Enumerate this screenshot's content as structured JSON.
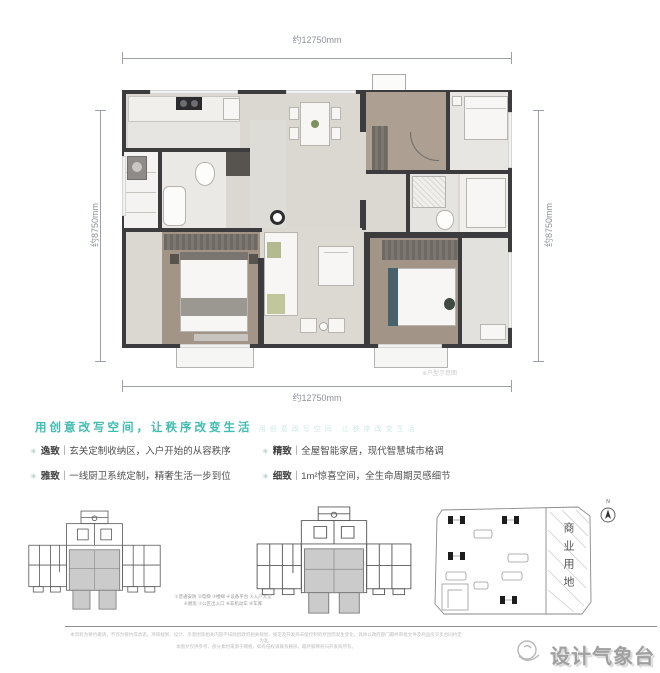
{
  "plan": {
    "dim_top": "约12750mm",
    "dim_bottom": "约12750mm",
    "dim_left": "约8750mm",
    "dim_right": "约8750mm",
    "note": "※户型示意图"
  },
  "headline": {
    "text": "用创意改写空间，让秩序改变生活",
    "echo": "用创意改写空间 让秩序改变生活"
  },
  "features": [
    {
      "tag": "逸致",
      "sep": "｜",
      "desc": "玄关定制收纳区，入户开始的从容秩序"
    },
    {
      "tag": "雅致",
      "sep": "｜",
      "desc": "一线厨卫系统定制，精奢生活一步到位"
    },
    {
      "tag": "精致",
      "sep": "｜",
      "desc": "全屋智能家居，现代智慧城市格调"
    },
    {
      "tag": "细致",
      "sep": "｜",
      "desc": "1m²惊喜空间，全生命周期灵感细节"
    }
  ],
  "keyplan": {
    "legend_line1": "①普通安防 ②电梯 ③楼梯 ④设备平台 ⑤入户大堂",
    "legend_line2": "⑥厨房 ⑦公区出入口 ⑧非机动车 ⑨车库"
  },
  "siteplan": {
    "label": "商业用地",
    "compass": "N"
  },
  "footer": {
    "disclaimer1": "本资料为要约邀请，不作为要约或承诺。项目规划、设计、示意图等相关内容不排除因政府相关规划、规定及开发商未能控制的原因而发生变化，具体以政府部门最终审批文件及商品房买卖合同约定为准。",
    "disclaimer2": "本图文仅供参考，部分素材来源于网络，如有侵权请联系删除，最终解释权归开发商所有。",
    "brand": "设计气象台"
  },
  "colors": {
    "accent": "#3fbdb0",
    "wall": "#3c3c3f",
    "wood": "#a29487",
    "brand_gray": "#a0a0a0"
  }
}
